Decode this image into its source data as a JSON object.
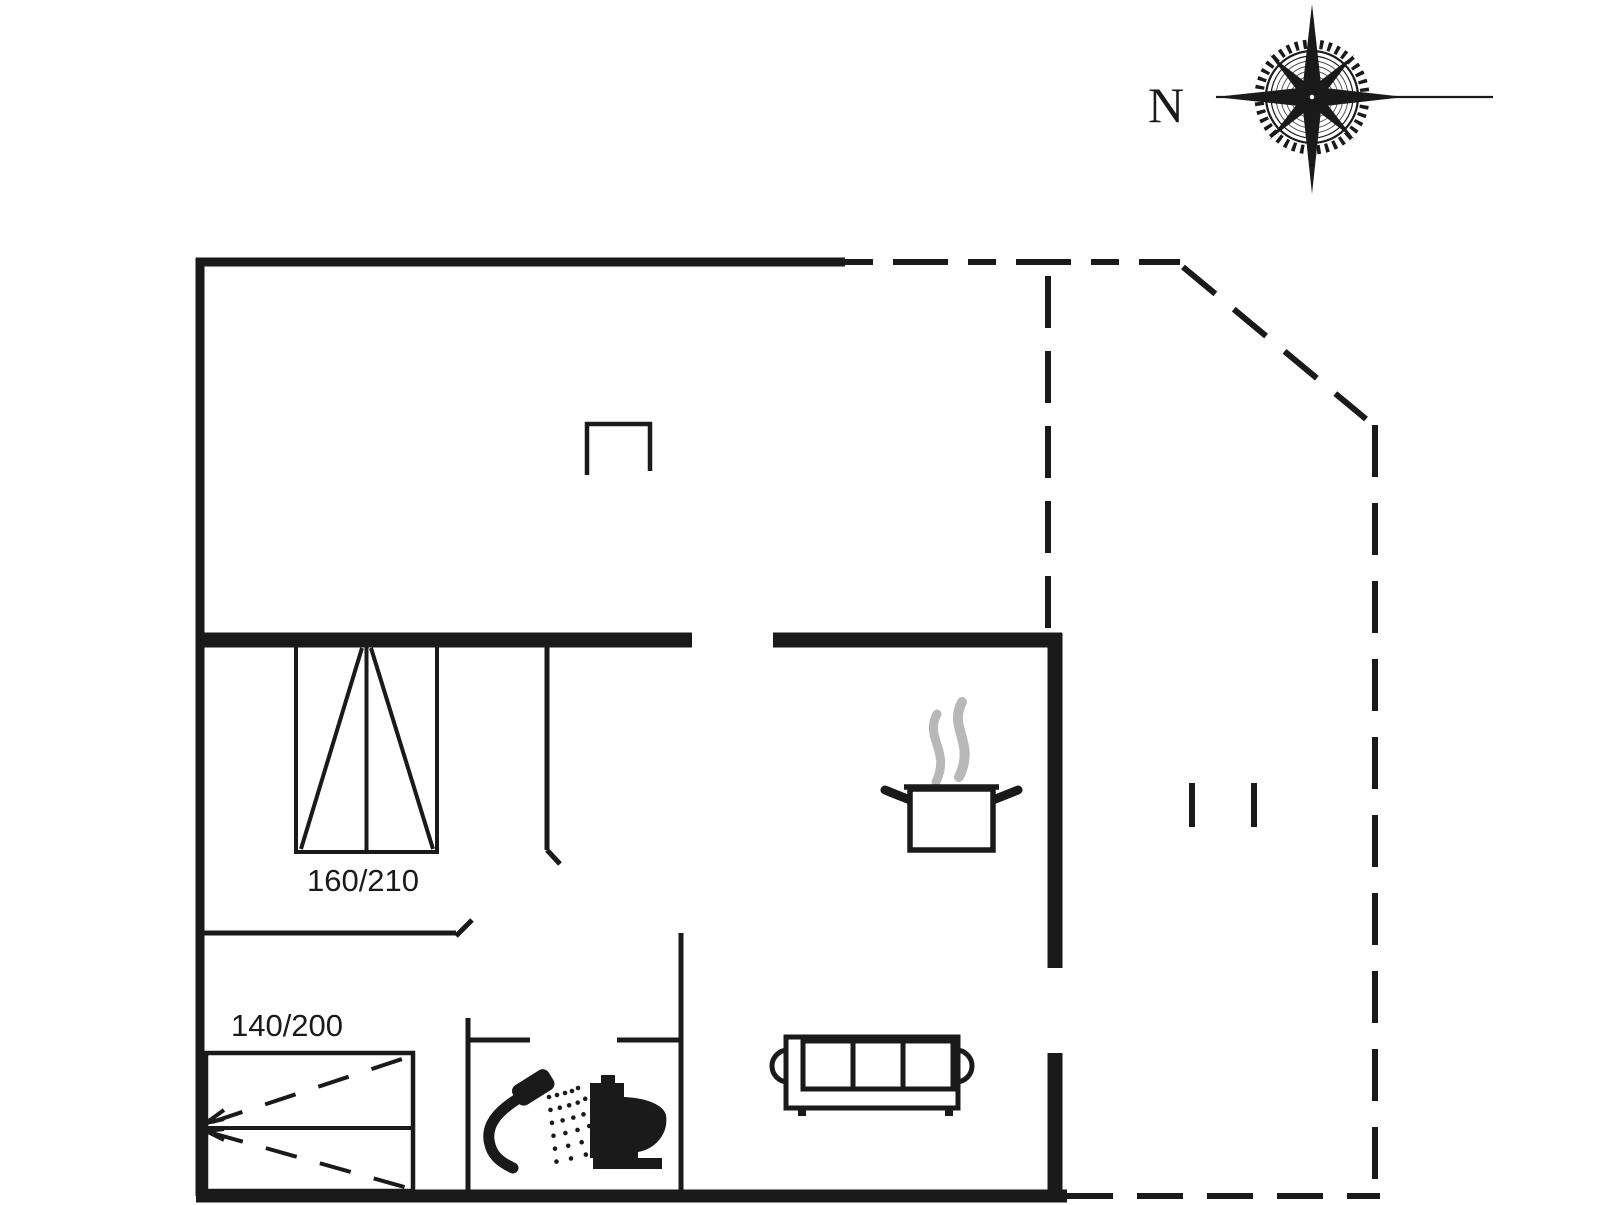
{
  "canvas": {
    "width": 1606,
    "height": 1205,
    "background": "#ffffff",
    "ink": "#1a1a1a",
    "steam_color": "#b8b8b8"
  },
  "compass": {
    "label": "N"
  },
  "rooms": {
    "bedroom_double": {
      "bed_size_label": "160/210"
    },
    "bedroom_bunk": {
      "bed_size_label": "140/200"
    }
  },
  "icons": [
    {
      "name": "compass-rose-icon"
    },
    {
      "name": "chimney-icon"
    },
    {
      "name": "cooking-pot-icon"
    },
    {
      "name": "steam-icon"
    },
    {
      "name": "sofa-icon"
    },
    {
      "name": "shower-icon"
    },
    {
      "name": "toilet-icon"
    },
    {
      "name": "double-bed-icon"
    },
    {
      "name": "bunk-bed-icon"
    },
    {
      "name": "terrace-opening-ticks"
    }
  ]
}
